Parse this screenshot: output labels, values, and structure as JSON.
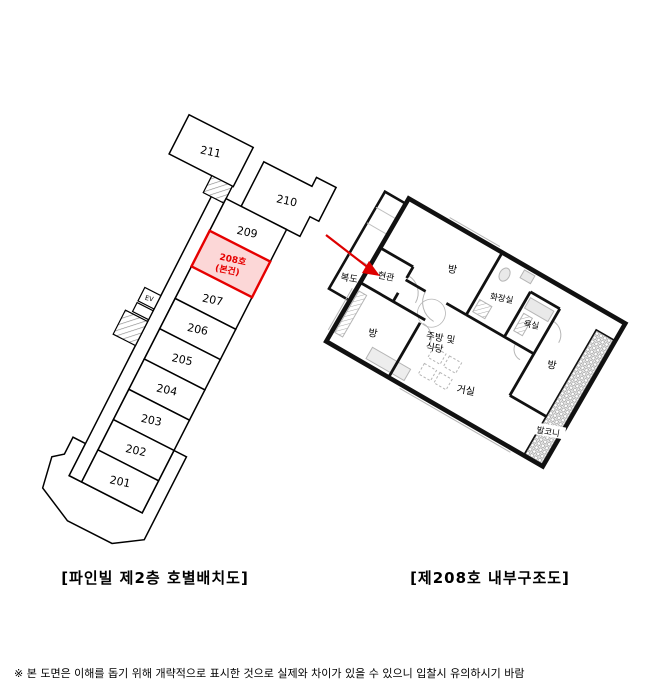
{
  "left_diagram": {
    "caption": "[파인빌 제2층 호별배치도]",
    "rooms": {
      "r201": "201",
      "r202": "202",
      "r203": "203",
      "r204": "204",
      "r205": "205",
      "r206": "206",
      "r207": "207",
      "r209": "209",
      "r210": "210",
      "r211": "211"
    },
    "highlight": {
      "line1": "208호",
      "line2": "(본건)"
    },
    "elevator_label": "EV"
  },
  "right_diagram": {
    "caption": "[제208호 내부구조도]",
    "rooms": {
      "corridor": "복도",
      "entrance": "현관",
      "room": "방",
      "toilet": "화장실",
      "bath": "욕실",
      "kitchen_line1": "주방 및",
      "kitchen_line2": "식당",
      "living": "거실",
      "balcony": "발코니"
    }
  },
  "footer": {
    "disclaimer": "※ 본 도면은 이해를 돕기 위해 개략적으로 표시한 것으로 실제와 차이가 있을 수 있으니 입찰시 유의하시기 바람"
  },
  "colors": {
    "line": "#000000",
    "highlight_fill": "#fcd7d7",
    "highlight_stroke": "#e60000",
    "highlight_text": "#e60000",
    "arrow": "#dd0000",
    "detail_gray": "#b5b5b5"
  }
}
